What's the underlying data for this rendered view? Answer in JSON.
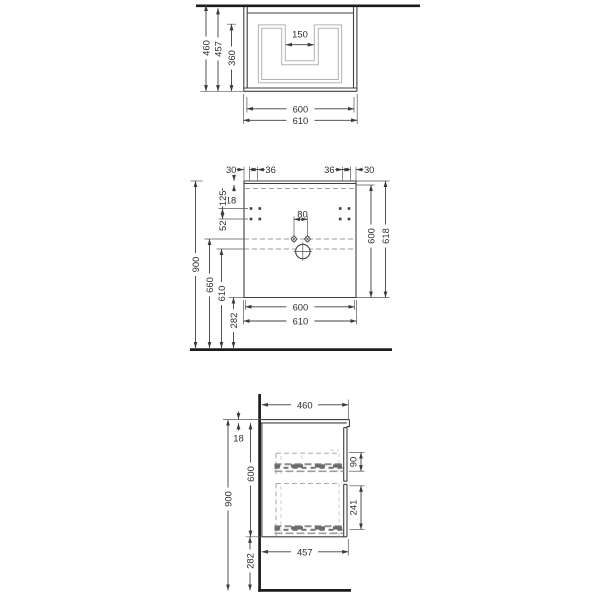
{
  "colors": {
    "line": "#3f3f3f",
    "heavy": "#1c1c1c",
    "light": "#b3b3b3",
    "dash": "#9e9e9e",
    "text": "#2d2d2d",
    "bg": "#ffffff",
    "hole": "#3d3d3d"
  },
  "top_view": {
    "dims": {
      "depth_total": "460",
      "depth_inner": "457",
      "basin_depth": "360",
      "cutout_width": "150",
      "width_inner": "600",
      "width_outer": "610"
    }
  },
  "front_view": {
    "dims": {
      "offset_left": "30",
      "spacing_left": "36",
      "spacing_right": "36",
      "offset_right": "30",
      "top_thickness": "18",
      "hole_offset": "125",
      "hole_spacing": "52",
      "tap_spacing": "80",
      "total_height": "900",
      "trap_height": "660",
      "drain_height": "610",
      "clearance": "282",
      "body_height": "600",
      "height_with_top": "618",
      "width_inner": "600",
      "width_outer": "610"
    }
  },
  "side_view": {
    "dims": {
      "depth": "460",
      "top_thickness": "18",
      "body_height": "600",
      "total_height": "900",
      "clearance": "282",
      "drawer_gap_upper": "90",
      "drawer_gap_lower": "241",
      "bottom_depth": "457"
    }
  }
}
